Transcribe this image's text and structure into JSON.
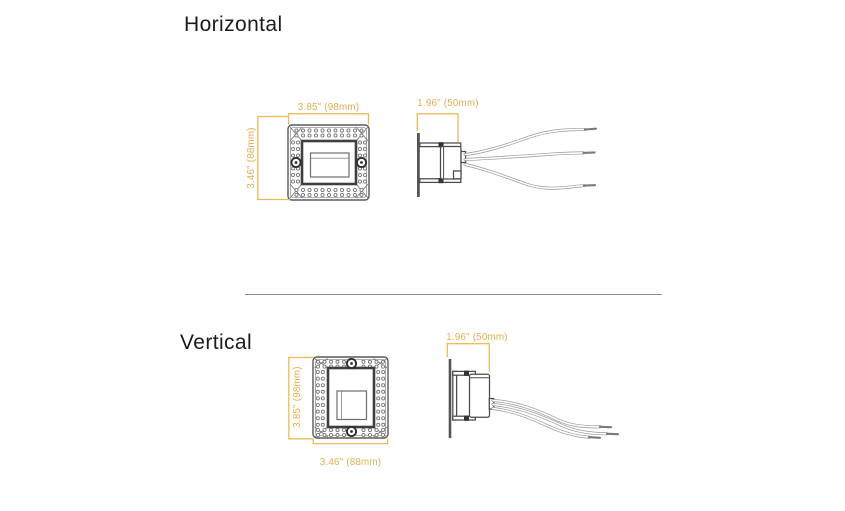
{
  "sections": [
    {
      "title": "Horizontal",
      "front_view": {
        "width_label": "3.85\" (98mm)",
        "height_label": "3.46\" (88mm)"
      },
      "side_view": {
        "depth_label": "1.96\" (50mm)"
      }
    },
    {
      "title": "Vertical",
      "front_view": {
        "width_label": "3.46\" (88mm)",
        "height_label": "3.85\" (98mm)"
      },
      "side_view": {
        "depth_label": "1.96\" (50mm)"
      }
    }
  ],
  "colors": {
    "dimension_accent": "#E2AE52",
    "line_art": "#58595B",
    "heading_text": "#1B1B1B"
  }
}
